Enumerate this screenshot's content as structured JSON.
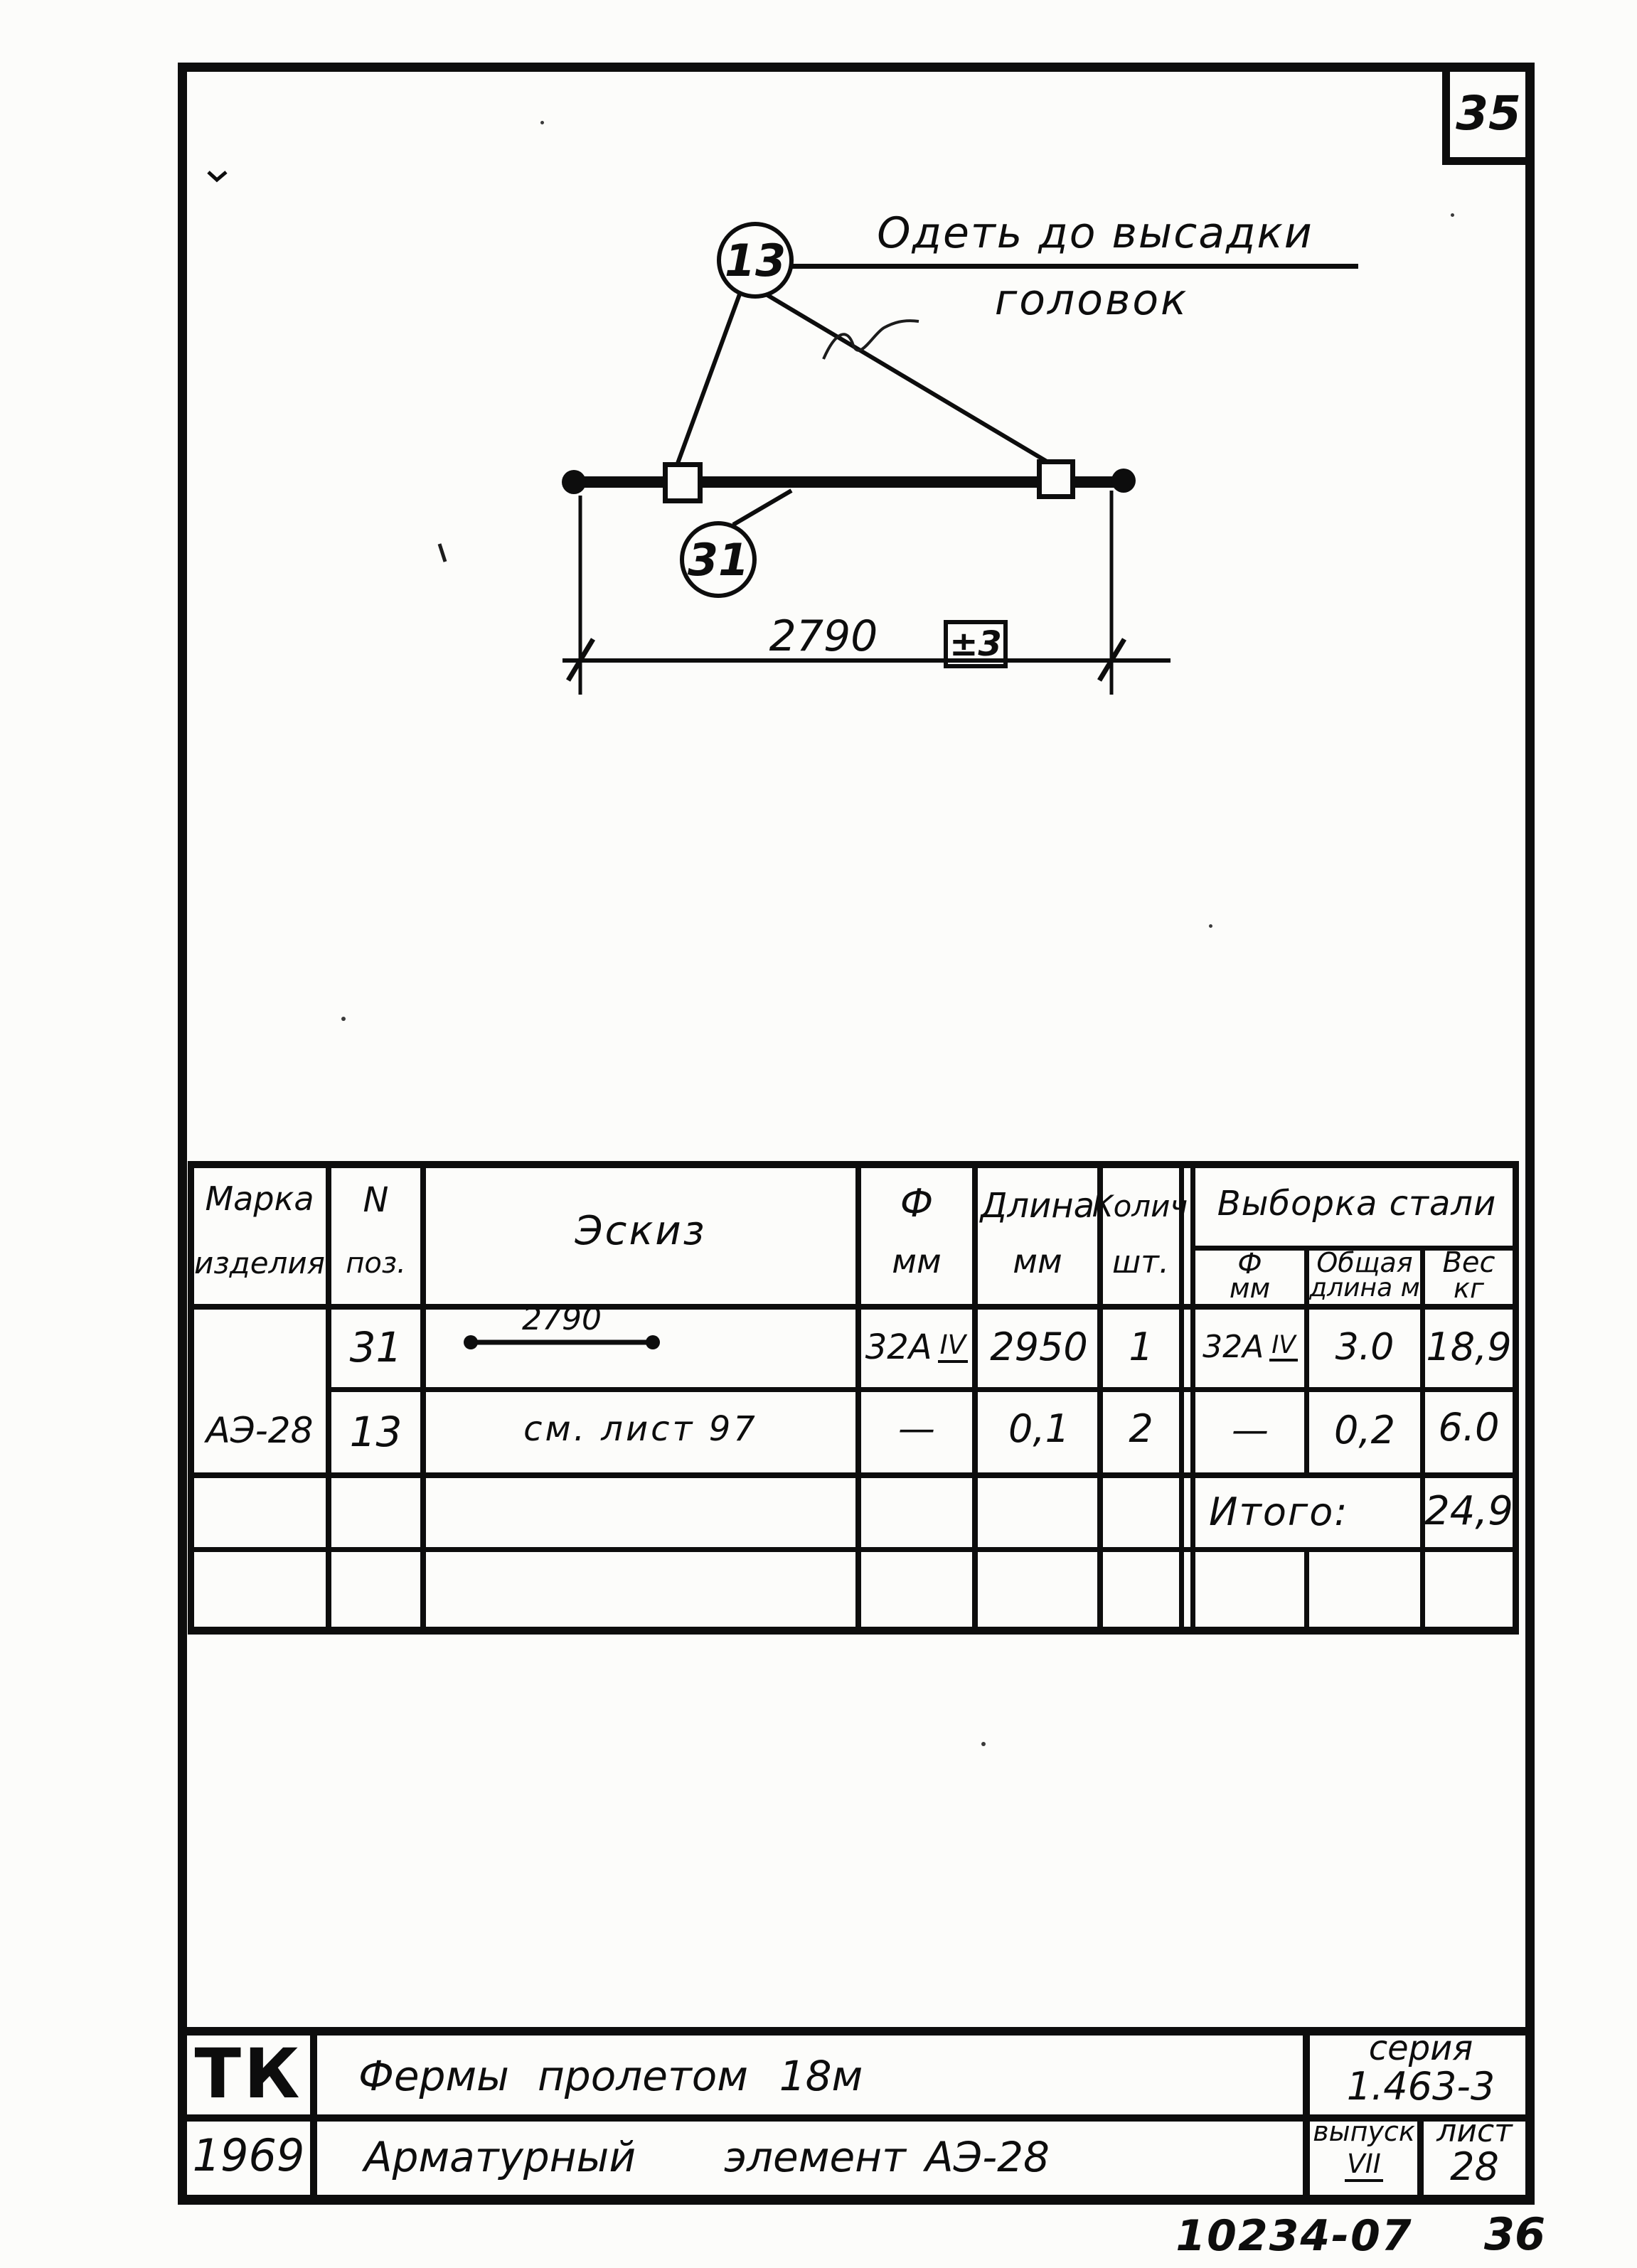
{
  "sheet": {
    "page_badge": "35",
    "footer_code": "10234-07",
    "footer_page": "36"
  },
  "drawing": {
    "callout_clamp": "13",
    "callout_bar": "31",
    "note_line1": "Одеть до высадки",
    "note_line2": "головок",
    "dim_value": "2790",
    "dim_tol": "±3"
  },
  "table": {
    "header": {
      "mark1": "Марка",
      "mark2": "изделия",
      "pos1": "N",
      "pos2": "поз.",
      "sketch": "Эскиз",
      "dia1": "Ф",
      "dia2": "мм",
      "len1": "Длина",
      "len2": "мм",
      "qty1": "Колич",
      "qty2": "шт.",
      "selection": "Выборка стали",
      "sel_dia1": "Ф",
      "sel_dia2": "мм",
      "sel_len1": "Общая",
      "sel_len2": "длина м",
      "sel_wt1": "Вес",
      "sel_wt2": "кг"
    },
    "mark": "АЭ-28",
    "rows": [
      {
        "pos": "31",
        "sketch_dim": "2790",
        "dia": "32А",
        "dia_class": "IV",
        "len": "2950",
        "qty": "1",
        "sel_dia": "32А",
        "sel_dia_class": "IV",
        "sel_len": "3.0",
        "wt": "18,9"
      },
      {
        "pos": "13",
        "sketch_note": "см. лист 97",
        "dia": "—",
        "len": "0,1",
        "qty": "2",
        "sel_dia": "—",
        "sel_len": "0,2",
        "wt": "6.0"
      }
    ],
    "total_label": "Итого:",
    "total_value": "24,9"
  },
  "title_block": {
    "org": "ТК",
    "year": "1969",
    "row1": [
      "Фермы",
      "пролетом",
      "18м"
    ],
    "row2": [
      "Арматурный",
      "элемент",
      "АЭ-28"
    ],
    "series_label": "серия",
    "series_value": "1.463-3",
    "issue_label": "выпуск",
    "issue_value": "VII",
    "sheet_label": "лист",
    "sheet_value": "28"
  }
}
